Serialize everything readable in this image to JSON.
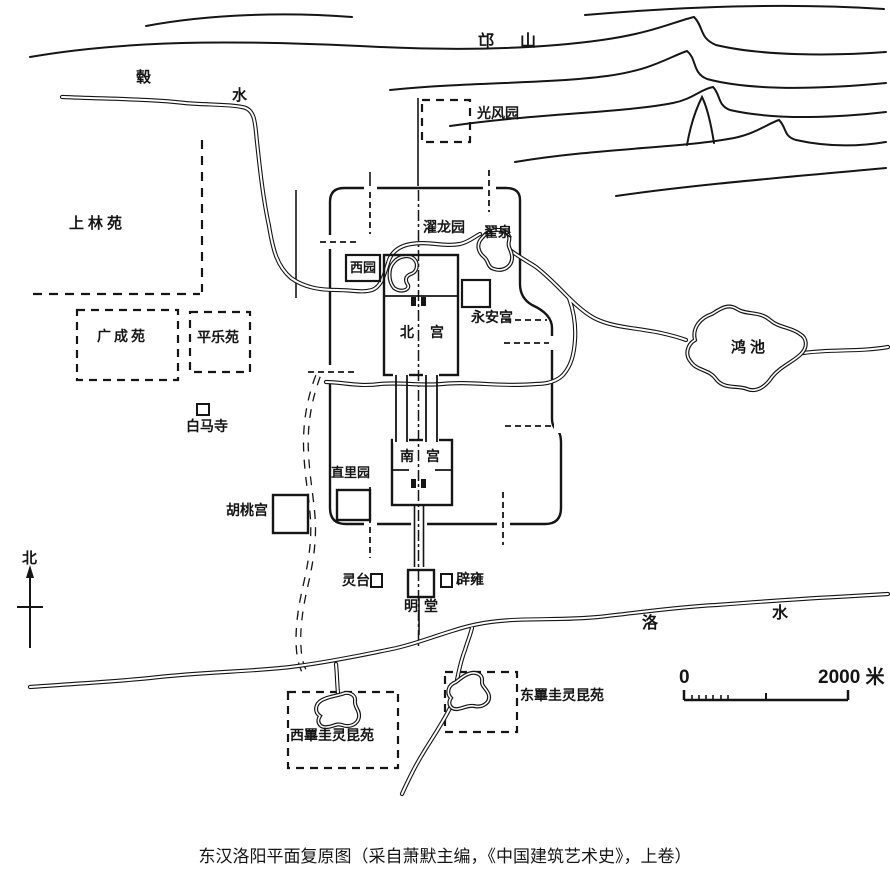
{
  "map": {
    "colors": {
      "ink": "#151515",
      "paper": "#ffffff"
    },
    "labels": {
      "mang_shan": "邙山",
      "gu_char": "毂",
      "gu_shui_char": "水",
      "guangfengyuan": "光风园",
      "shanglinyuan": "上林苑",
      "zhuolongyuan": "濯龙园",
      "zhaiquan": "翟泉",
      "xiyuan": "西园",
      "beigong": "北宫",
      "yonganggong": "永安宫",
      "guangchengyuan": "广成苑",
      "pingleyuan": "平乐苑",
      "baimasi": "白马寺",
      "hongchi": "鸿池",
      "hutaogong": "胡桃宫",
      "zhiliyuan": "直里园",
      "nangong": "南宫",
      "north": "北",
      "lingtai": "灵台",
      "biyong": "辟雍",
      "mingtang": "明堂",
      "luo_char": "洛",
      "luo_shui_char": "水",
      "dong_bigui": "东罼圭灵昆苑",
      "xi_bigui": "西罼圭灵昆苑"
    },
    "scale": {
      "zero": "0",
      "max": "2000 米"
    },
    "caption": "东汉洛阳平面复原图（采自萧默主编，《中国建筑艺术史》，上卷）"
  }
}
